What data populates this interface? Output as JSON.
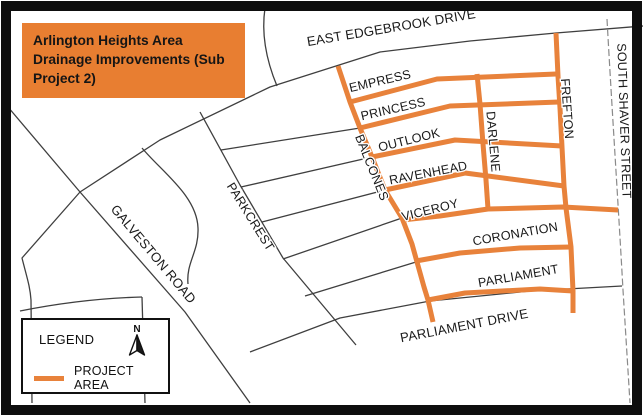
{
  "map_title": "Arlington Heights Area Drainage Improvements (Sub Project 2)",
  "legend": {
    "header": "LEGEND",
    "north_label": "N",
    "items": [
      {
        "label": "PROJECT AREA",
        "swatch": "orange-project-line"
      }
    ]
  },
  "streets": {
    "east_edgebrook": "EAST EDGEBROOK DRIVE",
    "south_shaver": "SOUTH SHAVER STREET",
    "galveston": "GALVESTON ROAD",
    "parkcrest": "PARKCREST",
    "balcones": "BALCONES",
    "empress": "EMPRESS",
    "princess": "PRINCESS",
    "outlook": "OUTLOOK",
    "ravenhead": "RAVENHEAD",
    "viceroy": "VICEROY",
    "darlene": "DARLENE",
    "frefton": "FREFTON",
    "coronation": "CORONATION",
    "parliament": "PARLIAMENT",
    "parliament_drive": "PARLIAMENT DRIVE"
  },
  "colors": {
    "project_area": "#E8823B",
    "title_bg": "#E87E31",
    "road": "#3f3f3f",
    "label": "#1a1a1a"
  }
}
